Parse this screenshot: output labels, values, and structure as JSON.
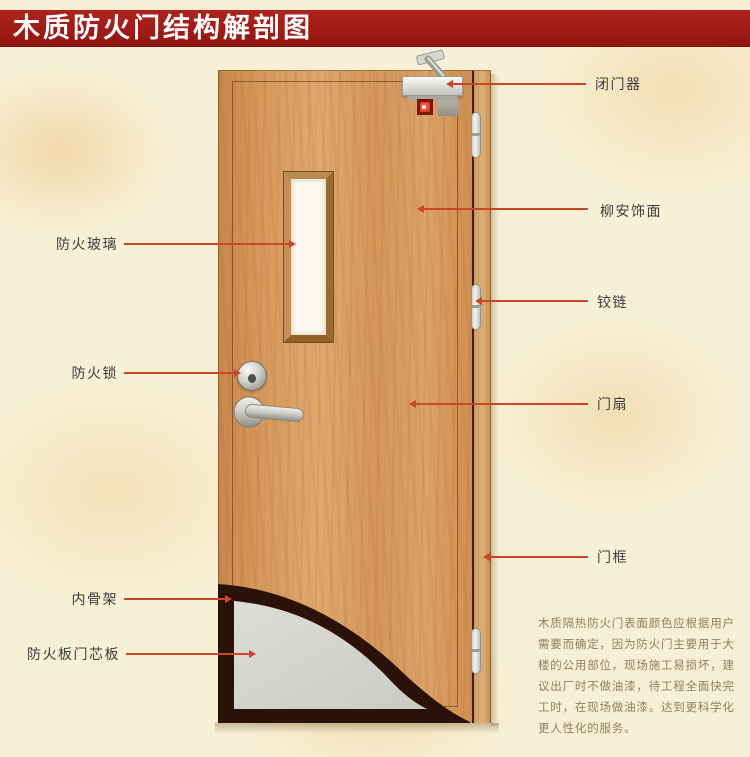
{
  "title": "木质防火门结构解剖图",
  "callouts": {
    "left": [
      {
        "label": "防火玻璃"
      },
      {
        "label": "防火锁"
      },
      {
        "label": "内骨架"
      },
      {
        "label": "防火板门芯板"
      }
    ],
    "right": [
      {
        "label": "闭门器"
      },
      {
        "label": "柳安饰面"
      },
      {
        "label": "铰链"
      },
      {
        "label": "门扇"
      },
      {
        "label": "门框"
      }
    ]
  },
  "description": {
    "lines": [
      "木质隔热防火门表面颜色应根据用户",
      "需要而确定，因为防火门主要用于大",
      "楼的公用部位，现场施工易损坏，建",
      "议出厂时不做油漆，待工程全面快完",
      "工时，在现场做油漆。达到更科学化",
      "更人性化的服务。"
    ]
  },
  "colors": {
    "banner": "#a11b16",
    "callout_line": "#cd4527",
    "background": "#f8f0d6",
    "door_wood": "#d89a5d",
    "core_board": "#d8d7d2",
    "inner_skeleton": "#2b1208"
  }
}
